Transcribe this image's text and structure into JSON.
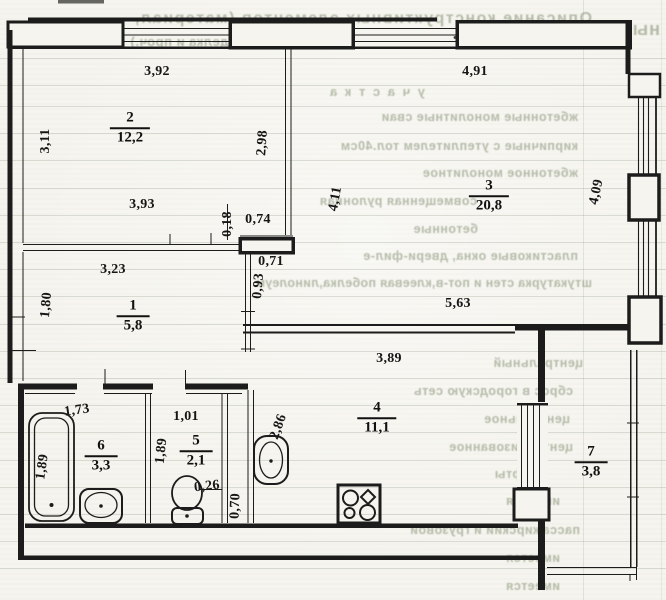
{
  "document_title": "apartment floor plan (scanned BTI drawing)",
  "colors": {
    "paper": "#f5f4ee",
    "ink": "#1c1c1c",
    "bleed_text": "#8a967c",
    "table_grid": "#8c9884"
  },
  "plan": {
    "rooms": [
      {
        "number": "2",
        "area": "12,2",
        "x": 130,
        "y": 128
      },
      {
        "number": "3",
        "area": "20,8",
        "x": 489,
        "y": 196
      },
      {
        "number": "1",
        "area": "5,8",
        "x": 133,
        "y": 316
      },
      {
        "number": "4",
        "area": "11,1",
        "x": 377,
        "y": 418
      },
      {
        "number": "6",
        "area": "3,3",
        "x": 101,
        "y": 456
      },
      {
        "number": "5",
        "area": "2,1",
        "x": 196,
        "y": 451
      },
      {
        "number": "7",
        "area": "3,8",
        "x": 591,
        "y": 462
      }
    ],
    "dimensions": [
      {
        "text": "3,92",
        "x": 157,
        "y": 72,
        "rotate": 0
      },
      {
        "text": "4,91",
        "x": 475,
        "y": 72,
        "rotate": 0
      },
      {
        "text": "3,11",
        "x": 46,
        "y": 141,
        "rotate": -90
      },
      {
        "text": "2,98",
        "x": 263,
        "y": 143,
        "rotate": -86
      },
      {
        "text": "4,11",
        "x": 336,
        "y": 199,
        "rotate": -80
      },
      {
        "text": "4,09",
        "x": 597,
        "y": 192,
        "rotate": -78
      },
      {
        "text": "3,93",
        "x": 142,
        "y": 205,
        "rotate": 0
      },
      {
        "text": "0,18",
        "x": 228,
        "y": 224,
        "rotate": -90
      },
      {
        "text": "0,74",
        "x": 258,
        "y": 220,
        "rotate": 0
      },
      {
        "text": "0,71",
        "x": 271,
        "y": 262,
        "rotate": 0
      },
      {
        "text": "0,93",
        "x": 259,
        "y": 286,
        "rotate": -85
      },
      {
        "text": "3,23",
        "x": 113,
        "y": 270,
        "rotate": 0
      },
      {
        "text": "1,80",
        "x": 47,
        "y": 305,
        "rotate": -85
      },
      {
        "text": "5,63",
        "x": 458,
        "y": 304,
        "rotate": 0
      },
      {
        "text": "3,89",
        "x": 389,
        "y": 359,
        "rotate": 0
      },
      {
        "text": "1,73",
        "x": 77,
        "y": 411,
        "rotate": -8
      },
      {
        "text": "1,01",
        "x": 186,
        "y": 417,
        "rotate": 0
      },
      {
        "text": "1,89",
        "x": 43,
        "y": 467,
        "rotate": -82
      },
      {
        "text": "1,89",
        "x": 162,
        "y": 451,
        "rotate": -84
      },
      {
        "text": "2,86",
        "x": 279,
        "y": 427,
        "rotate": -70
      },
      {
        "text": "0,26",
        "x": 207,
        "y": 487,
        "rotate": -6
      },
      {
        "text": "0,70",
        "x": 236,
        "y": 506,
        "rotate": -88
      }
    ],
    "fixtures": [
      {
        "icon": "bathtub-icon"
      },
      {
        "icon": "washbasin-icon"
      },
      {
        "icon": "toilet-icon"
      },
      {
        "icon": "hand-sink-icon"
      },
      {
        "icon": "stove-icon"
      }
    ]
  },
  "bleed_through": {
    "rows": [
      {
        "text": "Описание конструктивных элементов (материал,",
        "y": 10,
        "x_right": 592,
        "size": 16,
        "spacing": 1.5
      },
      {
        "text": "ных",
        "y": 19,
        "x_right": 660,
        "size": 18,
        "spacing": 1
      },
      {
        "text": "конструкция, отделка и проч.)",
        "y": 34,
        "x_right": 338,
        "size": 13,
        "spacing": 0.5
      },
      {
        "text": "у ч а с т к а",
        "y": 84,
        "x_right": 425,
        "size": 13,
        "spacing": 2
      },
      {
        "text": "жбетонные монолитные сваи",
        "y": 110,
        "x_right": 578,
        "size": 12.5,
        "spacing": 0.5
      },
      {
        "text": "кирпичные с утеплителем тол.40см",
        "y": 139,
        "x_right": 578,
        "size": 12.5,
        "spacing": 0.5
      },
      {
        "text": "жбетонное монолитное",
        "y": 166,
        "x_right": 578,
        "size": 12.5,
        "spacing": 0.5
      },
      {
        "text": "совмещенная рулонная",
        "y": 194,
        "x_right": 477,
        "size": 12.5,
        "spacing": 0.5
      },
      {
        "text": "бетонные",
        "y": 222,
        "x_right": 478,
        "size": 12.5,
        "spacing": 0.5
      },
      {
        "text": "пластиковые окна, двери-фил-е",
        "y": 249,
        "x_right": 578,
        "size": 12.5,
        "spacing": 0.5
      },
      {
        "text": "штукатурка стен и пот-в,клеевая побелка,линолеум",
        "y": 276,
        "x_right": 592,
        "size": 12.5,
        "spacing": 0.3
      },
      {
        "text": "центральный",
        "y": 356,
        "x_right": 583,
        "size": 12.5,
        "spacing": 0.5
      },
      {
        "text": "сброс в городскую сеть",
        "y": 384,
        "x_right": 573,
        "size": 12.5,
        "spacing": 0.5
      },
      {
        "text": "центральное",
        "y": 412,
        "x_right": 570,
        "size": 12.5,
        "spacing": 0.5
      },
      {
        "text": "централизованное",
        "y": 440,
        "x_right": 573,
        "size": 12.5,
        "spacing": 0.5
      },
      {
        "text": "лифты",
        "y": 467,
        "x_right": 540,
        "size": 12.5,
        "spacing": 0.5
      },
      {
        "text": "имеется",
        "y": 494,
        "x_right": 560,
        "size": 12.5,
        "spacing": 0.5
      },
      {
        "text": "пассажирский и грузовой",
        "y": 523,
        "x_right": 580,
        "size": 12.5,
        "spacing": 0.5
      },
      {
        "text": "имеется",
        "y": 551,
        "x_right": 560,
        "size": 12.5,
        "spacing": 0.5
      },
      {
        "text": "имеется",
        "y": 579,
        "x_right": 560,
        "size": 12.5,
        "spacing": 0.5
      }
    ]
  }
}
